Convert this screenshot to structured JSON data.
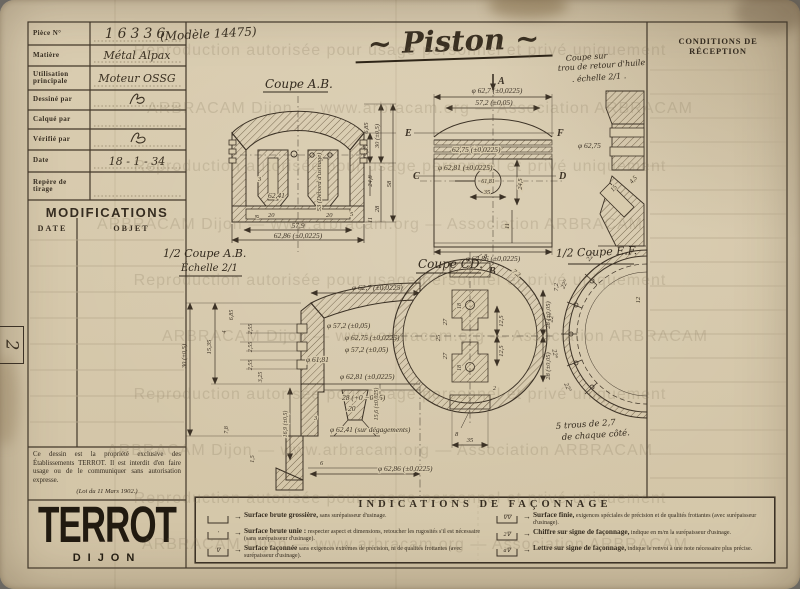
{
  "sheet": {
    "model_note": "(Modèle 14475)",
    "title": "~ Piston ~",
    "conditions_title": "CONDITIONS DE RÉCEPTION",
    "margin_mark": "2"
  },
  "title_block": {
    "rows": [
      {
        "label": "Pièce N°",
        "value": "16336"
      },
      {
        "label": "Matière",
        "value": "Métal Alpax"
      },
      {
        "label": "Utilisation principale",
        "value": "Moteur OSSG"
      },
      {
        "label": "Dessiné par",
        "value": ""
      },
      {
        "label": "Calqué par",
        "value": ""
      },
      {
        "label": "Vérifié par",
        "value": ""
      },
      {
        "label": "Date",
        "value": "18 - 1 - 34"
      },
      {
        "label": "Repère de tirage",
        "value": ""
      }
    ]
  },
  "modifications": {
    "title": "MODIFICATIONS",
    "col_date": "DATE",
    "col_objet": "OBJET"
  },
  "ownership": {
    "text": "Ce dessin est la propriété exclusive des Établissements TERROT. Il est interdit d'en faire usage ou de le communiquer sans autorisation expresse.",
    "law": "(Loi du 11 Mars 1902.)"
  },
  "logo": {
    "name": "TERROT",
    "city": "DIJON"
  },
  "views": {
    "coupeAB": {
      "title": "Coupe A.B.",
      "dims": [
        "3",
        "62,41",
        "53 (Débord d'usinage)",
        "20",
        "20",
        "5",
        "8",
        "57,9",
        "62,86 (±0,0225)",
        "6,85",
        "30 (±0,5)",
        "15,35",
        "24,8",
        "58",
        "28",
        "11"
      ]
    },
    "elevation": {
      "letters": [
        "A",
        "B",
        "E",
        "F",
        "C",
        "D"
      ],
      "dims": [
        "φ 62,7 (±0,0225)",
        "57,2 (±0,05)",
        "62,75 (±0,0225)",
        "φ 62,81 (±0,0225)",
        "61,81",
        "35",
        "24,5",
        "11",
        "φ 62,86 (±0,0225)"
      ]
    },
    "detail": {
      "note1": "Coupe sur",
      "note2": "trou de retour d'huile",
      "note3": ". échelle 2/1 .",
      "dims": [
        "φ 62,75",
        "15",
        "4,5"
      ]
    },
    "halfAB": {
      "title": "1/2 Coupe A.B.",
      "scale": "Échelle 2/1",
      "dims": [
        "φ 62,7 (±0,0225)",
        "30 (±0,5)",
        "15,35",
        "6,85",
        "4",
        "2,55",
        "2,55",
        "2,55",
        "3,25",
        "7,8",
        "1,5",
        "φ 57,2 (±0,05)",
        "φ 62,75 (±0,0225)",
        "φ 57,2 (±0,05)",
        "φ 61,81",
        "φ 62,81 (±0,0225)",
        "28 (+0 −0,05)",
        "20",
        "15,6 (±0,025)",
        "16,9 (±0,5)",
        "3",
        "φ 62,41 (sur dégagements)",
        "6",
        "φ 62,86 (±0,0225)"
      ]
    },
    "coupeCD": {
      "title": "Coupe CD.",
      "dims": [
        "8",
        "7,2",
        "7,2",
        "12,5",
        "12,5",
        "27",
        "25",
        "27",
        "18",
        "18",
        "28 (±0,05)",
        "28 (±0,05)",
        "8",
        "35",
        "2"
      ]
    },
    "halfEF": {
      "title": "1/2 Coupe E.F.",
      "note1": "5 trous de 2,7",
      "note2": "de chaque côté.",
      "dims": [
        "12"
      ],
      "angles": [
        "22°",
        "22°",
        "22°",
        "22°",
        "22°"
      ]
    }
  },
  "faconnage": {
    "title": "INDICATIONS DE FAÇONNAGE",
    "arrow": "→",
    "items": [
      {
        "symbol": "",
        "name": "Surface brute grossière,",
        "desc": "sans surépaisseur d'usinage."
      },
      {
        "symbol": "′",
        "name": "Surface brute unie :",
        "desc": "respecter aspect et dimensions, retoucher les rugosités s'il est nécessaire (sans surépaisseur d'usinage)."
      },
      {
        "symbol": "∇",
        "name": "Surface façonnée",
        "desc": "sans exigences extrêmes de précision, ni de qualités frottantes (avec surépaisseur d'usinage)."
      },
      {
        "symbol": "∇∇",
        "name": "Surface finie,",
        "desc": "exigences spéciales de précision et de qualités frottantes (avec surépaisseur d'usinage)."
      },
      {
        "symbol": "2∇",
        "name": "Chiffre sur signe de façonnage,",
        "desc": "indique en m/m la surépaisseur d'usinage."
      },
      {
        "symbol": "a∇",
        "name": "Lettre sur signe de façonnage,",
        "desc": "indique le renvoi à une note nécessaire plus précise."
      }
    ]
  },
  "watermark": {
    "line1": "ARBRACAM Dijon — www.arbracam.org — Association ARBRACAM",
    "line2": "Reproduction autorisée pour usage personnel et privé uniquement"
  }
}
